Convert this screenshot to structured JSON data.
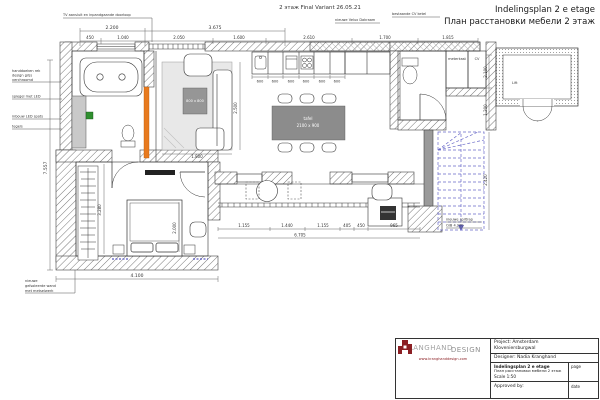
{
  "sheet": {
    "variant_note": "2 этаж Final Variant 26.05.21",
    "title_nl": "Indelingsplan 2 e etage",
    "title_ru": "План расстановки мебели 2 этаж"
  },
  "colors": {
    "logo_red": "#8b1f24",
    "accent_orange": "#e87a1e",
    "stair_blue": "#6a6ac8",
    "marker_green": "#2f8f2f"
  },
  "plan": {
    "notes": {
      "tv": "TV aansluit en inpandgaande doorloop",
      "velux": "nieuwe Velux Dakraam",
      "cv_ketel": "bestaande CV ketel",
      "towel_1": "handdoeken rek",
      "towel_2": "design grijs",
      "towel_3": "verchroomd",
      "mirror": "spiegel met LED",
      "led": "inbouw LED spots",
      "tiles": "tegels",
      "wall_1": "nieuwe",
      "wall_2": "geïsoleerde wand",
      "wall_3": "met metselwerk",
      "stair_1": "nieuwe spiltrap",
      "stair_2": "O/B 4.200"
    },
    "room_labels": {
      "meterkast": "meterkast",
      "cv": "CV",
      "lift": "Lift"
    },
    "furniture_labels": {
      "dining_1": "tafel",
      "dining_2": "2100 x 900",
      "coffee_table": "800 x 800"
    },
    "dims": {
      "top_row1": [
        "2.200",
        "3.675"
      ],
      "top_row2": [
        "450",
        "1.040",
        "2.050",
        "1.600",
        "2.610",
        "1.700",
        "1.815"
      ],
      "kitchen_units": [
        "600",
        "600",
        "600",
        "600",
        "600",
        "600"
      ],
      "left_total": "7.557",
      "bedroom_width": "4.100",
      "bedroom_depth": "3.280",
      "bed": "2.000",
      "living_w": "1.800",
      "living_h": "2.500",
      "hall": [
        "1.155",
        "1.440",
        "1.155",
        "405",
        "450",
        "965"
      ],
      "hall_total": "6.705",
      "right_1": "2.100",
      "right_2": "1.200",
      "stairs_h": "2.420"
    }
  },
  "title_block": {
    "brand_main": "KRANGHAND",
    "brand_sub": "DESIGN",
    "website": "www.kranghanddesign.com",
    "project_1": "Project: Amsterdam",
    "project_2": "Kloveniersburgwal",
    "designer": "Designer: Nadia Kranghand",
    "doc_title_nl": "Indelingsplan 2 e etage",
    "doc_title_ru": "План расстановки мебели 2 этаж",
    "scale": "Scale 1:50",
    "page_label": "page",
    "approved_label": "Approved by:",
    "date_label": "date"
  }
}
